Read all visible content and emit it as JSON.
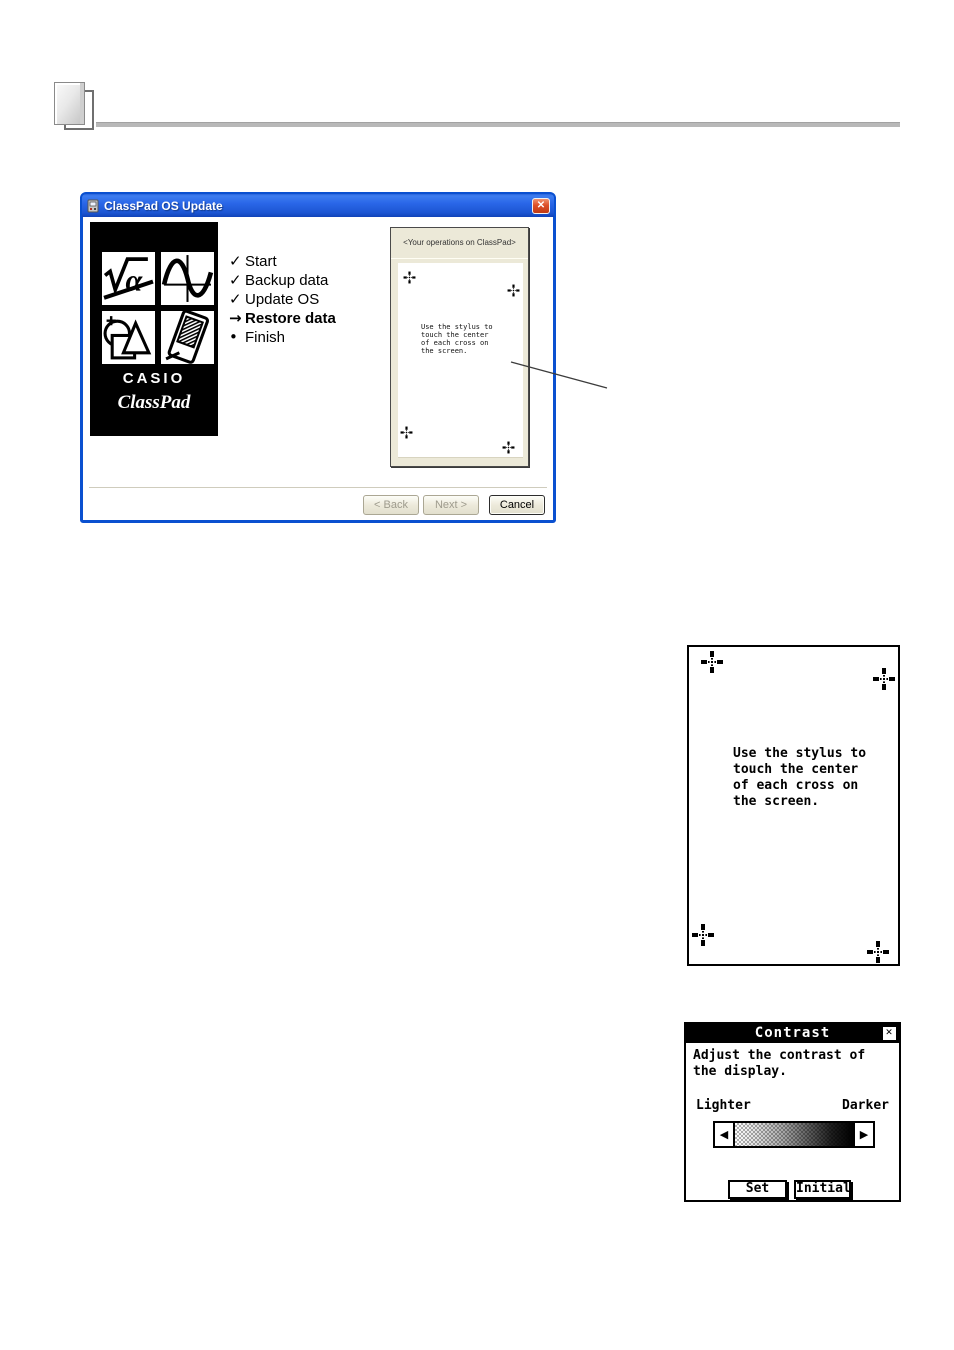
{
  "wizard": {
    "title": "ClassPad OS Update",
    "close": "✕",
    "logo": {
      "brand": "CASIO",
      "product": "ClassPad"
    },
    "steps": [
      {
        "marker": "✓",
        "label": "Start"
      },
      {
        "marker": "✓",
        "label": "Backup data"
      },
      {
        "marker": "✓",
        "label": "Update OS"
      },
      {
        "marker": "→",
        "label": "Restore data"
      },
      {
        "marker": "•",
        "label": "Finish"
      }
    ],
    "ops_panel": {
      "header": "<Your operations on ClassPad>"
    },
    "buttons": {
      "back": "< Back",
      "next": "Next >",
      "cancel": "Cancel"
    }
  },
  "screen_text": {
    "lines": [
      "Use the stylus to",
      "touch the center",
      "of each cross on",
      "the screen."
    ]
  },
  "contrast": {
    "title": "Contrast",
    "close": "✕",
    "message_lines": [
      "Adjust the contrast of",
      "the display."
    ],
    "lighter": "Lighter",
    "darker": "Darker",
    "left_arrow": "◀",
    "right_arrow": "▶",
    "set": "Set",
    "initial": "Initial"
  },
  "colors": {
    "titlebar_blue": "#1c55d2",
    "panel_beige": "#ece9d8",
    "header_rule": "#b8b8b8"
  }
}
